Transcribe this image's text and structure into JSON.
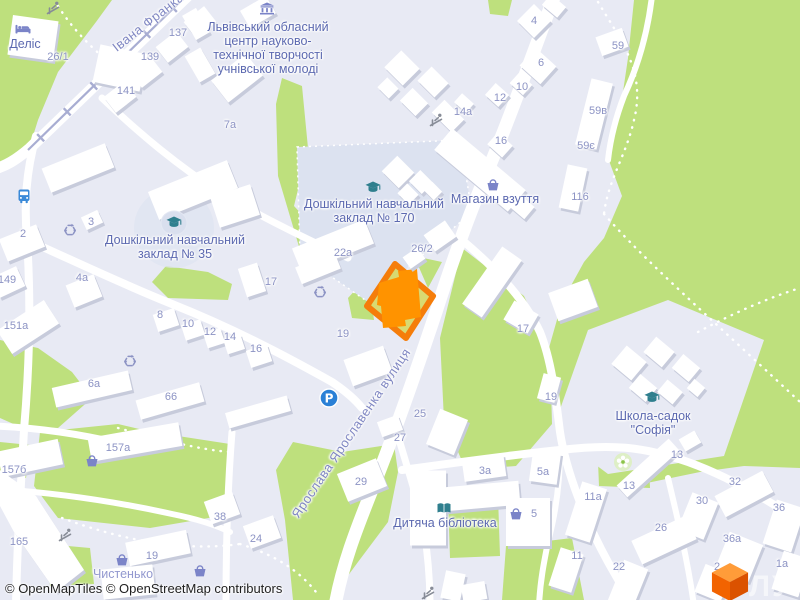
{
  "attribution": "© OpenMapTiles © OpenStreetMap contributors",
  "logo_text": "ЛУН",
  "colors": {
    "park": "#BEE07D",
    "urban": "#E8EAF4",
    "road": "#FFFFFF",
    "selection_outline": "#F57D0A",
    "selection_fill": "#D6D75B",
    "selected_building": "#FF9300",
    "poi_label": "#5C69B0",
    "house_number": "#8C93C4",
    "street_label": "#7F86C2",
    "tram_line": "#A8ADD2",
    "icon_teal": "#2F7F8E",
    "icon_indigo": "#7B84C8",
    "bus_blue": "#3B8AD8",
    "parking_blue": "#2A80D6"
  },
  "streets": [
    {
      "name": "Івана Франка",
      "x": 148,
      "y": 22,
      "rot": -38
    },
    {
      "name": "Ярослава Ярославенка вулиця",
      "x": 351,
      "y": 433,
      "rot": -56
    }
  ],
  "pois": [
    {
      "name": "hotel-delis",
      "lines": [
        "Деліс"
      ],
      "x": 25,
      "y": 37
    },
    {
      "name": "lviv-center",
      "lines": [
        "Львівський обласний",
        "центр науково-",
        "технічної творчості",
        "учнівської молоді"
      ],
      "x": 268,
      "y": 20
    },
    {
      "name": "kindergarten-170",
      "lines": [
        "Дошкільний навчальний",
        "заклад № 170"
      ],
      "x": 374,
      "y": 197
    },
    {
      "name": "shoe-shop",
      "lines": [
        "Магазин взуття"
      ],
      "x": 495,
      "y": 192
    },
    {
      "name": "kindergarten-35",
      "lines": [
        "Дошкільний навчальний",
        "заклад № 35"
      ],
      "x": 175,
      "y": 233
    },
    {
      "name": "school-sofia",
      "lines": [
        "Школа-садок",
        "\"Софія\""
      ],
      "x": 653,
      "y": 409
    },
    {
      "name": "children-library",
      "lines": [
        "Дитяча бібліотека"
      ],
      "x": 445,
      "y": 516
    },
    {
      "name": "chystenko-shop",
      "lines": [
        "Чистенько"
      ],
      "x": 123,
      "y": 567,
      "light": true
    }
  ],
  "house_numbers": [
    {
      "t": "26/1",
      "x": 58,
      "y": 57
    },
    {
      "t": "137",
      "x": 178,
      "y": 33
    },
    {
      "t": "139",
      "x": 150,
      "y": 57
    },
    {
      "t": "141",
      "x": 126,
      "y": 91
    },
    {
      "t": "7a",
      "x": 230,
      "y": 125
    },
    {
      "t": "4",
      "x": 534,
      "y": 21
    },
    {
      "t": "6",
      "x": 541,
      "y": 63
    },
    {
      "t": "10",
      "x": 522,
      "y": 87
    },
    {
      "t": "12",
      "x": 500,
      "y": 98
    },
    {
      "t": "14a",
      "x": 463,
      "y": 112
    },
    {
      "t": "16",
      "x": 501,
      "y": 141
    },
    {
      "t": "59",
      "x": 618,
      "y": 46
    },
    {
      "t": "59в",
      "x": 598,
      "y": 111
    },
    {
      "t": "59є",
      "x": 586,
      "y": 146
    },
    {
      "t": "116",
      "x": 580,
      "y": 197
    },
    {
      "t": "2",
      "x": 23,
      "y": 234
    },
    {
      "t": "3",
      "x": 91,
      "y": 222
    },
    {
      "t": "149",
      "x": 7,
      "y": 280
    },
    {
      "t": "4a",
      "x": 82,
      "y": 278
    },
    {
      "t": "17",
      "x": 271,
      "y": 282
    },
    {
      "t": "22a",
      "x": 343,
      "y": 253
    },
    {
      "t": "26/2",
      "x": 422,
      "y": 249
    },
    {
      "t": "151a",
      "x": 16,
      "y": 326
    },
    {
      "t": "8",
      "x": 160,
      "y": 315
    },
    {
      "t": "10",
      "x": 188,
      "y": 324
    },
    {
      "t": "12",
      "x": 210,
      "y": 332
    },
    {
      "t": "14",
      "x": 230,
      "y": 337
    },
    {
      "t": "16",
      "x": 256,
      "y": 349
    },
    {
      "t": "6a",
      "x": 94,
      "y": 384
    },
    {
      "t": "66",
      "x": 171,
      "y": 397
    },
    {
      "t": "19",
      "x": 343,
      "y": 334
    },
    {
      "t": "17",
      "x": 523,
      "y": 329
    },
    {
      "t": "19",
      "x": 551,
      "y": 397
    },
    {
      "t": "25",
      "x": 420,
      "y": 414
    },
    {
      "t": "27",
      "x": 400,
      "y": 438
    },
    {
      "t": "29",
      "x": 361,
      "y": 482
    },
    {
      "t": "3a",
      "x": 485,
      "y": 471
    },
    {
      "t": "5a",
      "x": 543,
      "y": 472
    },
    {
      "t": "5",
      "x": 534,
      "y": 514
    },
    {
      "t": "157a",
      "x": 118,
      "y": 448
    },
    {
      "t": "157б",
      "x": 14,
      "y": 470
    },
    {
      "t": "165",
      "x": 19,
      "y": 542
    },
    {
      "t": "19",
      "x": 152,
      "y": 556
    },
    {
      "t": "38",
      "x": 220,
      "y": 517
    },
    {
      "t": "24",
      "x": 256,
      "y": 539
    },
    {
      "t": "13",
      "x": 677,
      "y": 455
    },
    {
      "t": "13",
      "x": 629,
      "y": 486
    },
    {
      "t": "32",
      "x": 735,
      "y": 482
    },
    {
      "t": "30",
      "x": 702,
      "y": 501
    },
    {
      "t": "36",
      "x": 779,
      "y": 508
    },
    {
      "t": "26",
      "x": 661,
      "y": 528
    },
    {
      "t": "36a",
      "x": 732,
      "y": 539
    },
    {
      "t": "11a",
      "x": 593,
      "y": 497
    },
    {
      "t": "11",
      "x": 577,
      "y": 556
    },
    {
      "t": "22",
      "x": 619,
      "y": 567
    },
    {
      "t": "2",
      "x": 717,
      "y": 567
    },
    {
      "t": "1a",
      "x": 782,
      "y": 564
    }
  ],
  "icons": [
    {
      "name": "playground-icon",
      "type": "playground",
      "x": 53,
      "y": 8
    },
    {
      "name": "hotel-bed-icon",
      "type": "bed",
      "x": 23,
      "y": 29
    },
    {
      "name": "museum-icon",
      "type": "museum",
      "x": 267,
      "y": 9
    },
    {
      "name": "kindergarten-170-icon",
      "type": "grad",
      "x": 373,
      "y": 188
    },
    {
      "name": "shop-basket-icon",
      "type": "basket",
      "x": 493,
      "y": 185
    },
    {
      "name": "kindergarten-35-icon",
      "type": "grad",
      "x": 174,
      "y": 223,
      "bg": true
    },
    {
      "name": "bus-stop-icon",
      "type": "bus",
      "x": 24,
      "y": 196
    },
    {
      "name": "recycling-icon",
      "type": "recycle",
      "x": 70,
      "y": 230
    },
    {
      "name": "recycling-icon",
      "type": "recycle",
      "x": 320,
      "y": 292
    },
    {
      "name": "recycling-icon",
      "type": "recycle",
      "x": 130,
      "y": 361
    },
    {
      "name": "playground-icon",
      "type": "playground",
      "x": 436,
      "y": 120
    },
    {
      "name": "parking-icon",
      "type": "parking",
      "x": 329,
      "y": 398
    },
    {
      "name": "school-sofia-icon",
      "type": "grad",
      "x": 652,
      "y": 398
    },
    {
      "name": "florist-icon",
      "type": "flower",
      "x": 623,
      "y": 462
    },
    {
      "name": "library-book-icon",
      "type": "book",
      "x": 444,
      "y": 508
    },
    {
      "name": "shop-basket-icon",
      "type": "basket",
      "x": 516,
      "y": 514
    },
    {
      "name": "shop-basket-icon",
      "type": "basket",
      "x": 92,
      "y": 461
    },
    {
      "name": "shop-basket-icon",
      "type": "basket",
      "x": 122,
      "y": 560
    },
    {
      "name": "shop-basket-icon",
      "type": "basket",
      "x": 200,
      "y": 571
    },
    {
      "name": "playground-icon",
      "type": "playground",
      "x": 65,
      "y": 535
    },
    {
      "name": "playground-icon",
      "type": "playground",
      "x": 428,
      "y": 593
    }
  ]
}
